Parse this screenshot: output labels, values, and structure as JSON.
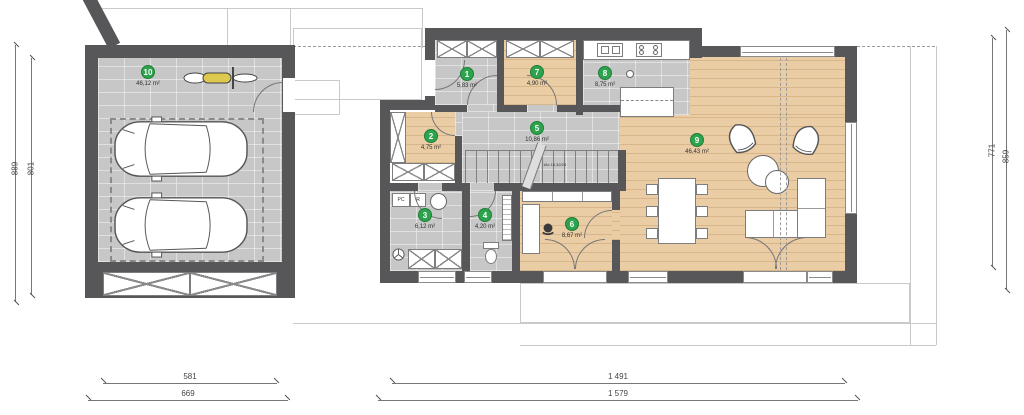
{
  "plan": {
    "rooms": [
      {
        "number": "1",
        "area": "5,83 m²"
      },
      {
        "number": "2",
        "area": "4,75 m²"
      },
      {
        "number": "3",
        "area": "6,12 m²"
      },
      {
        "number": "4",
        "area": "4,20 m²"
      },
      {
        "number": "5",
        "area": "10,86 m²"
      },
      {
        "number": "6",
        "area": "8,67 m²"
      },
      {
        "number": "7",
        "area": "4,90 m²"
      },
      {
        "number": "8",
        "area": "8,75 m²"
      },
      {
        "number": "9",
        "area": "46,43 m²"
      },
      {
        "number": "10",
        "area": "46,12 m²"
      }
    ],
    "dimensions": {
      "left_outer": "889",
      "left_inner": "801",
      "right_inner": "771",
      "right_outer": "859",
      "garage_inner": "581",
      "garage_outer": "669",
      "house_inner": "1 491",
      "house_outer": "1 579"
    },
    "labels": {
      "pc": "PC",
      "r": "R",
      "stair_note": "18x 18,32/25"
    },
    "colors": {
      "wall": "#57575a",
      "tile": "#c7c7c7",
      "wood": "#eacda5",
      "badge_green": "#2ea34e"
    }
  }
}
